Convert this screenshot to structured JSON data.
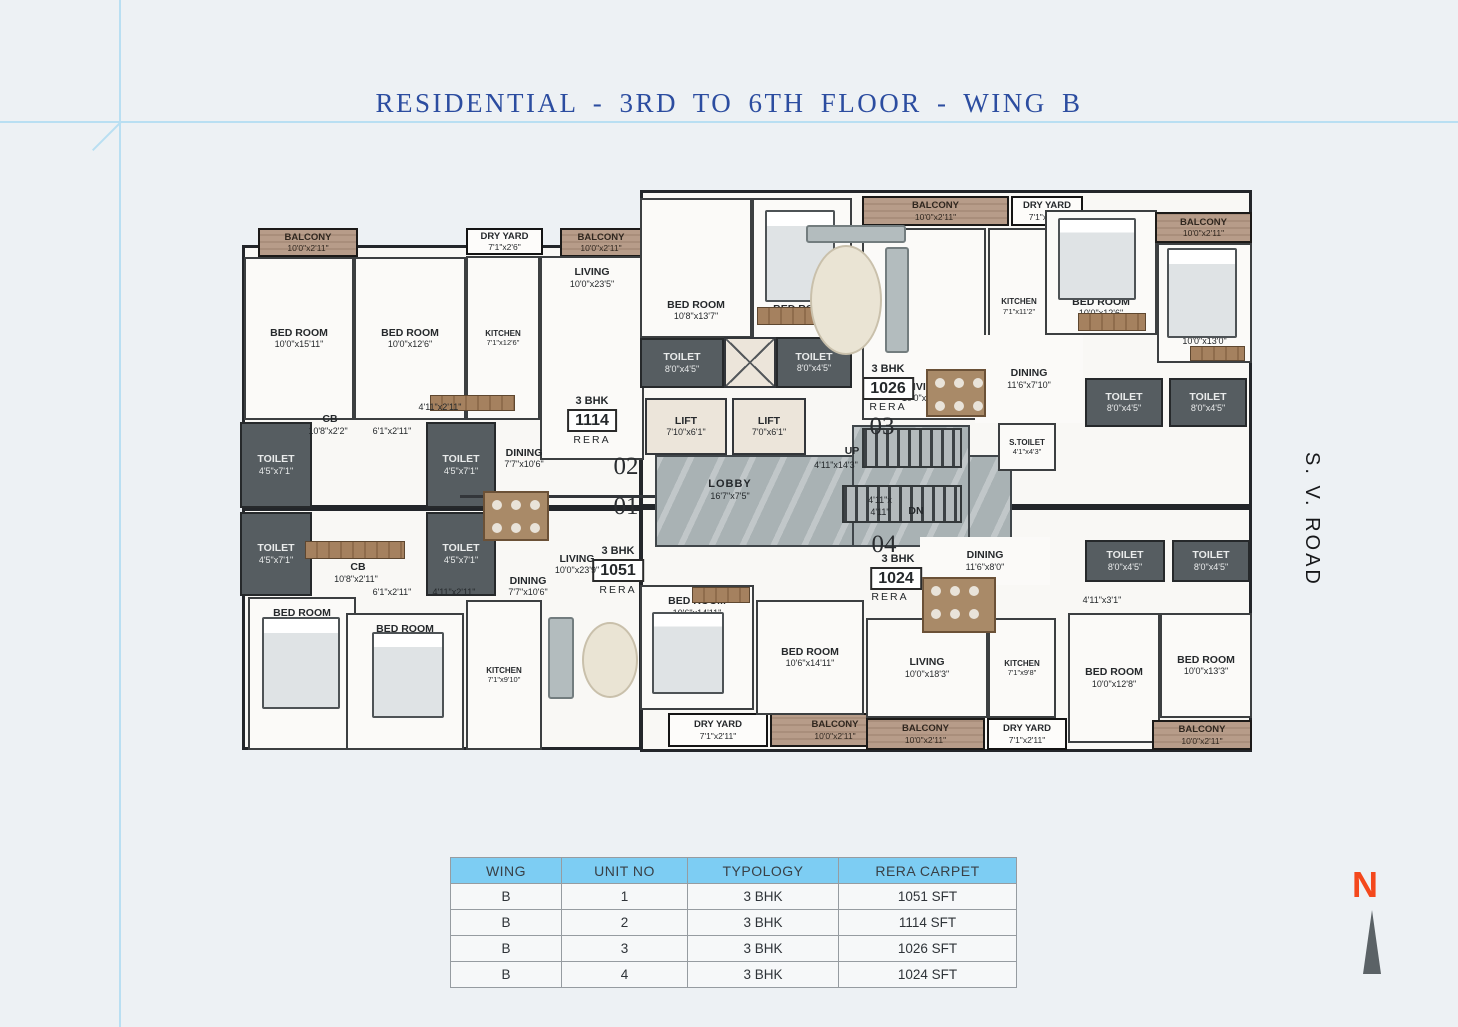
{
  "title": "RESIDENTIAL - 3RD TO 6TH FLOOR - WING B",
  "road_label": "S. V. ROAD",
  "north_label": "N",
  "table": {
    "headers": [
      "WING",
      "UNIT NO",
      "TYPOLOGY",
      "RERA CARPET"
    ],
    "rows": [
      [
        "B",
        "1",
        "3 BHK",
        "1051 SFT"
      ],
      [
        "B",
        "2",
        "3 BHK",
        "1114 SFT"
      ],
      [
        "B",
        "3",
        "3 BHK",
        "1026 SFT"
      ],
      [
        "B",
        "4",
        "3 BHK",
        "1024 SFT"
      ]
    ]
  },
  "colors": {
    "title_blue": "#2c4da0",
    "guide_blue": "#b9dff2",
    "table_header": "#7dcdf3",
    "toilet_gray": "#565d61",
    "balcony_tan": "#b79c89",
    "marble_gray": "#a9b2b4",
    "north_orange": "#f4481c"
  },
  "plan": {
    "units": [
      {
        "unit": "02",
        "type": "3 BHK",
        "rera": "1114"
      },
      {
        "unit": "01",
        "type": "3 BHK",
        "rera": "1051"
      },
      {
        "unit": "03",
        "type": "3 BHK",
        "rera": "1026"
      },
      {
        "unit": "04",
        "type": "3 BHK",
        "rera": "1024"
      }
    ],
    "rooms": [
      {
        "type": "unit",
        "x": 2,
        "y": 60,
        "w": 400,
        "h": 263
      },
      {
        "type": "unit",
        "x": 2,
        "y": 323,
        "w": 400,
        "h": 242
      },
      {
        "type": "unit",
        "x": 400,
        "y": 5,
        "w": 612,
        "h": 317
      },
      {
        "type": "unit",
        "x": 400,
        "y": 322,
        "w": 612,
        "h": 245
      },
      {
        "type": "marble",
        "x": 415,
        "y": 270,
        "w": 357,
        "h": 92
      },
      {
        "type": "marble",
        "x": 612,
        "y": 240,
        "w": 118,
        "h": 122
      },
      {
        "type": "stairs",
        "x": 622,
        "y": 243,
        "w": 100,
        "h": 40
      },
      {
        "type": "stairs",
        "x": 602,
        "y": 300,
        "w": 120,
        "h": 38
      },
      {
        "type": "balcony",
        "name": "BALCONY",
        "dims": "10'0\"x2'11\"",
        "x": 18,
        "y": 43,
        "w": 100,
        "h": 29
      },
      {
        "type": "dryyard",
        "name": "DRY YARD",
        "dims": "7'1\"x2'6\"",
        "x": 226,
        "y": 43,
        "w": 77,
        "h": 27
      },
      {
        "type": "balcony",
        "name": "BALCONY",
        "dims": "10'0\"x2'11\"",
        "x": 320,
        "y": 43,
        "w": 82,
        "h": 29
      },
      {
        "type": "room",
        "name": "BED ROOM",
        "dims": "10'0\"x15'11\"",
        "x": 4,
        "y": 72,
        "w": 110,
        "h": 163
      },
      {
        "type": "room",
        "name": "BED ROOM",
        "dims": "10'0\"x12'6\"",
        "x": 114,
        "y": 72,
        "w": 112,
        "h": 163
      },
      {
        "type": "room",
        "name": "KITCHEN",
        "dims": "7'1\"x12'6\"",
        "x": 226,
        "y": 71,
        "w": 74,
        "h": 164,
        "small": true
      },
      {
        "type": "room",
        "name": "LIVING",
        "dims": "10'0\"x23'5\"",
        "x": 300,
        "y": 71,
        "w": 104,
        "h": 204,
        "lp": "top"
      },
      {
        "type": "toilet",
        "name": "TOILET",
        "dims": "4'5\"x7'1\"",
        "x": 0,
        "y": 237,
        "w": 72,
        "h": 86
      },
      {
        "type": "toilet",
        "name": "TOILET",
        "dims": "4'5\"x7'1\"",
        "x": 186,
        "y": 237,
        "w": 70,
        "h": 86
      },
      {
        "type": "toilet",
        "name": "TOILET",
        "dims": "4'5\"x7'1\"",
        "x": 0,
        "y": 327,
        "w": 72,
        "h": 84
      },
      {
        "type": "toilet",
        "name": "TOILET",
        "dims": "4'5\"x7'1\"",
        "x": 186,
        "y": 327,
        "w": 70,
        "h": 84
      },
      {
        "type": "room",
        "name": "BED ROOM",
        "dims": "10'0\"x15'3\"",
        "x": 8,
        "y": 412,
        "w": 108,
        "h": 153,
        "lp": "top"
      },
      {
        "type": "room",
        "name": "BED ROOM",
        "dims": "10'0\"x11'10\"",
        "x": 106,
        "y": 428,
        "w": 118,
        "h": 137,
        "lp": "top"
      },
      {
        "type": "room",
        "name": "KITCHEN",
        "dims": "7'1\"x9'10\"",
        "x": 226,
        "y": 415,
        "w": 76,
        "h": 150,
        "small": true
      },
      {
        "type": "dryyard",
        "name": "DRY YARD",
        "dims": "7'1\"x2'11\"",
        "x": 428,
        "y": 528,
        "w": 100,
        "h": 34
      },
      {
        "type": "balcony",
        "name": "BALCONY",
        "dims": "10'0\"x2'11\"",
        "x": 530,
        "y": 528,
        "w": 130,
        "h": 34
      },
      {
        "type": "room",
        "name": "BED ROOM",
        "dims": "10'8\"x13'7\"",
        "x": 400,
        "y": 13,
        "w": 112,
        "h": 140,
        "lp": "bottom"
      },
      {
        "type": "room",
        "name": "BED ROOM",
        "dims": "10'6\"x13'7\"",
        "x": 512,
        "y": 13,
        "w": 100,
        "h": 144,
        "lp": "bottom"
      },
      {
        "type": "toilet",
        "name": "TOILET",
        "dims": "8'0\"x4'5\"",
        "x": 400,
        "y": 153,
        "w": 84,
        "h": 50
      },
      {
        "type": "shaft",
        "x": 484,
        "y": 152,
        "w": 52,
        "h": 51
      },
      {
        "type": "toilet",
        "name": "TOILET",
        "dims": "8'0\"x4'5\"",
        "x": 536,
        "y": 152,
        "w": 76,
        "h": 51
      },
      {
        "type": "lift",
        "name": "LIFT",
        "dims": "7'10\"x6'1\"",
        "x": 405,
        "y": 213,
        "w": 82,
        "h": 57
      },
      {
        "type": "lift",
        "name": "LIFT",
        "dims": "7'0\"x6'1\"",
        "x": 492,
        "y": 213,
        "w": 74,
        "h": 57
      },
      {
        "type": "room",
        "name": "S.TOILET",
        "dims": "4'1\"x4'3\"",
        "x": 758,
        "y": 238,
        "w": 58,
        "h": 48,
        "small": true
      },
      {
        "type": "balcony",
        "name": "BALCONY",
        "dims": "10'0\"x2'11\"",
        "x": 622,
        "y": 11,
        "w": 147,
        "h": 30
      },
      {
        "type": "dryyard",
        "name": "DRY YARD",
        "dims": "7'1\"x2'11\"",
        "x": 771,
        "y": 11,
        "w": 72,
        "h": 30
      },
      {
        "type": "room",
        "name": "LIVING",
        "dims": "10'0\"x19'6\"",
        "x": 622,
        "y": 43,
        "w": 124,
        "h": 192,
        "lp": "bottom"
      },
      {
        "type": "room",
        "name": "KITCHEN",
        "dims": "7'1\"x11'2\"",
        "x": 748,
        "y": 43,
        "w": 62,
        "h": 157,
        "small": true
      },
      {
        "type": "open",
        "name": "DINING",
        "dims": "11'6\"x7'10\"",
        "x": 735,
        "y": 150,
        "w": 108,
        "h": 88
      },
      {
        "type": "room",
        "name": "BED ROOM",
        "dims": "10'0\"x12'6\"",
        "x": 805,
        "y": 25,
        "w": 112,
        "h": 125,
        "lp": "bottom"
      },
      {
        "type": "balcony",
        "name": "BALCONY",
        "dims": "10'0\"x2'11\"",
        "x": 915,
        "y": 27,
        "w": 97,
        "h": 31
      },
      {
        "type": "room",
        "name": "BED ROOM",
        "dims": "10'0\"x13'0\"",
        "x": 917,
        "y": 58,
        "w": 95,
        "h": 120,
        "lp": "bottom"
      },
      {
        "type": "toilet",
        "name": "TOILET",
        "dims": "8'0\"x4'5\"",
        "x": 845,
        "y": 193,
        "w": 78,
        "h": 49
      },
      {
        "type": "toilet",
        "name": "TOILET",
        "dims": "8'0\"x4'5\"",
        "x": 929,
        "y": 193,
        "w": 78,
        "h": 49
      },
      {
        "type": "open",
        "name": "DINING",
        "dims": "11'6\"x8'0\"",
        "x": 680,
        "y": 352,
        "w": 130,
        "h": 48
      },
      {
        "type": "toilet",
        "name": "TOILET",
        "dims": "8'0\"x4'5\"",
        "x": 845,
        "y": 355,
        "w": 80,
        "h": 42
      },
      {
        "type": "toilet",
        "name": "TOILET",
        "dims": "8'0\"x4'5\"",
        "x": 932,
        "y": 355,
        "w": 78,
        "h": 42
      },
      {
        "type": "room",
        "name": "BED ROOM",
        "dims": "10'6\"x14'11\"",
        "x": 400,
        "y": 400,
        "w": 114,
        "h": 125,
        "lp": "top"
      },
      {
        "type": "room",
        "name": "BED ROOM",
        "dims": "10'6\"x14'11\"",
        "x": 516,
        "y": 415,
        "w": 108,
        "h": 115
      },
      {
        "type": "room",
        "name": "LIVING",
        "dims": "10'0\"x18'3\"",
        "x": 626,
        "y": 433,
        "w": 122,
        "h": 100
      },
      {
        "type": "room",
        "name": "KITCHEN",
        "dims": "7'1\"x9'8\"",
        "x": 748,
        "y": 433,
        "w": 68,
        "h": 100,
        "small": true
      },
      {
        "type": "room",
        "name": "BED ROOM",
        "dims": "10'0\"x12'8\"",
        "x": 828,
        "y": 428,
        "w": 92,
        "h": 130
      },
      {
        "type": "room",
        "name": "BED ROOM",
        "dims": "10'0\"x13'3\"",
        "x": 920,
        "y": 428,
        "w": 92,
        "h": 105
      },
      {
        "type": "balcony",
        "name": "BALCONY",
        "dims": "10'0\"x2'11\"",
        "x": 626,
        "y": 533,
        "w": 119,
        "h": 32
      },
      {
        "type": "dryyard",
        "name": "DRY YARD",
        "dims": "7'1\"x2'11\"",
        "x": 747,
        "y": 533,
        "w": 80,
        "h": 32
      },
      {
        "type": "balcony",
        "name": "BALCONY",
        "dims": "10'0\"x2'11\"",
        "x": 912,
        "y": 535,
        "w": 100,
        "h": 30
      }
    ],
    "texts": [
      {
        "t": "CB",
        "x": 90,
        "y": 228,
        "s": "rn"
      },
      {
        "t": "10'8\"x2'2\"",
        "x": 88,
        "y": 241,
        "s": "dm"
      },
      {
        "t": "6'1\"x2'11\"",
        "x": 152,
        "y": 241,
        "s": "dm"
      },
      {
        "t": "4'11\"x2'11\"",
        "x": 200,
        "y": 217,
        "s": "dm"
      },
      {
        "t": "DINING",
        "x": 284,
        "y": 262,
        "s": "rn"
      },
      {
        "t": "7'7\"x10'6\"",
        "x": 284,
        "y": 274,
        "s": "dm"
      },
      {
        "t": "3 BHK",
        "x": 352,
        "y": 210,
        "s": "bhk"
      },
      {
        "t": "1114",
        "x": 352,
        "y": 224,
        "s": "box"
      },
      {
        "t": "RERA",
        "x": 352,
        "y": 249,
        "s": "rera"
      },
      {
        "t": "02",
        "x": 386,
        "y": 268,
        "s": "big"
      },
      {
        "t": "01",
        "x": 386,
        "y": 308,
        "s": "big"
      },
      {
        "t": "3 BHK",
        "x": 378,
        "y": 360,
        "s": "bhk"
      },
      {
        "t": "1051",
        "x": 378,
        "y": 374,
        "s": "box"
      },
      {
        "t": "RERA",
        "x": 378,
        "y": 399,
        "s": "rera"
      },
      {
        "t": "LIVING",
        "x": 337,
        "y": 368,
        "s": "rn"
      },
      {
        "t": "10'0\"x23'9\"",
        "x": 337,
        "y": 380,
        "s": "dm"
      },
      {
        "t": "DINING",
        "x": 288,
        "y": 390,
        "s": "rn"
      },
      {
        "t": "7'7\"x10'6\"",
        "x": 288,
        "y": 402,
        "s": "dm"
      },
      {
        "t": "CB",
        "x": 118,
        "y": 376,
        "s": "rn"
      },
      {
        "t": "10'8\"x2'11\"",
        "x": 116,
        "y": 389,
        "s": "dm"
      },
      {
        "t": "6'1\"x2'11\"",
        "x": 152,
        "y": 402,
        "s": "dm"
      },
      {
        "t": "4'11\"x2'11\"",
        "x": 214,
        "y": 402,
        "s": "dm"
      },
      {
        "t": "LOBBY",
        "x": 490,
        "y": 293,
        "s": "lob"
      },
      {
        "t": "16'7\"x7'5\"",
        "x": 490,
        "y": 306,
        "s": "dm"
      },
      {
        "t": "UP",
        "x": 612,
        "y": 260,
        "s": "rn"
      },
      {
        "t": "4'11\"x14'3\"",
        "x": 596,
        "y": 275,
        "s": "dm"
      },
      {
        "t": "4'11\"x",
        "x": 640,
        "y": 310,
        "s": "dm"
      },
      {
        "t": "4'11\"",
        "x": 640,
        "y": 322,
        "s": "dm"
      },
      {
        "t": "DN",
        "x": 676,
        "y": 320,
        "s": "rn"
      },
      {
        "t": "3 BHK",
        "x": 648,
        "y": 178,
        "s": "bhk"
      },
      {
        "t": "1026",
        "x": 648,
        "y": 192,
        "s": "box"
      },
      {
        "t": "RERA",
        "x": 648,
        "y": 216,
        "s": "rera"
      },
      {
        "t": "03",
        "x": 642,
        "y": 228,
        "s": "big"
      },
      {
        "t": "04",
        "x": 644,
        "y": 346,
        "s": "big"
      },
      {
        "t": "3 BHK",
        "x": 658,
        "y": 368,
        "s": "bhk"
      },
      {
        "t": "1024",
        "x": 656,
        "y": 382,
        "s": "box"
      },
      {
        "t": "RERA",
        "x": 650,
        "y": 406,
        "s": "rera"
      },
      {
        "t": "4'11\"x3'1\"",
        "x": 862,
        "y": 410,
        "s": "dm"
      }
    ],
    "furniture": [
      {
        "kind": "line",
        "x": 220,
        "y": 310,
        "w": 195,
        "h": 3
      },
      {
        "kind": "bed",
        "x": 525,
        "y": 25,
        "w": 70,
        "h": 92
      },
      {
        "kind": "bed",
        "x": 818,
        "y": 33,
        "w": 78,
        "h": 82
      },
      {
        "kind": "bed",
        "x": 927,
        "y": 63,
        "w": 70,
        "h": 90
      },
      {
        "kind": "bed",
        "x": 22,
        "y": 432,
        "w": 78,
        "h": 92
      },
      {
        "kind": "bed",
        "x": 132,
        "y": 447,
        "w": 72,
        "h": 86
      },
      {
        "kind": "bed",
        "x": 412,
        "y": 427,
        "w": 72,
        "h": 82
      },
      {
        "kind": "wd",
        "x": 517,
        "y": 122,
        "w": 62,
        "h": 18
      },
      {
        "kind": "wd",
        "x": 838,
        "y": 128,
        "w": 68,
        "h": 18
      },
      {
        "kind": "wd",
        "x": 950,
        "y": 161,
        "w": 55,
        "h": 15
      },
      {
        "kind": "wd",
        "x": 452,
        "y": 402,
        "w": 58,
        "h": 16
      },
      {
        "kind": "wd",
        "x": 65,
        "y": 356,
        "w": 100,
        "h": 18
      },
      {
        "kind": "wd",
        "x": 190,
        "y": 210,
        "w": 85,
        "h": 16
      },
      {
        "kind": "table",
        "x": 243,
        "y": 306,
        "w": 66,
        "h": 50
      },
      {
        "kind": "table",
        "x": 686,
        "y": 184,
        "w": 60,
        "h": 48
      },
      {
        "kind": "table",
        "x": 682,
        "y": 392,
        "w": 74,
        "h": 56
      },
      {
        "kind": "rug",
        "x": 570,
        "y": 60,
        "w": 72,
        "h": 110
      },
      {
        "kind": "sofa",
        "x": 566,
        "y": 40,
        "w": 100,
        "h": 18
      },
      {
        "kind": "sofa",
        "x": 645,
        "y": 62,
        "w": 24,
        "h": 106
      },
      {
        "kind": "rug",
        "x": 342,
        "y": 437,
        "w": 56,
        "h": 76
      },
      {
        "kind": "sofa",
        "x": 308,
        "y": 432,
        "w": 26,
        "h": 82
      }
    ]
  }
}
